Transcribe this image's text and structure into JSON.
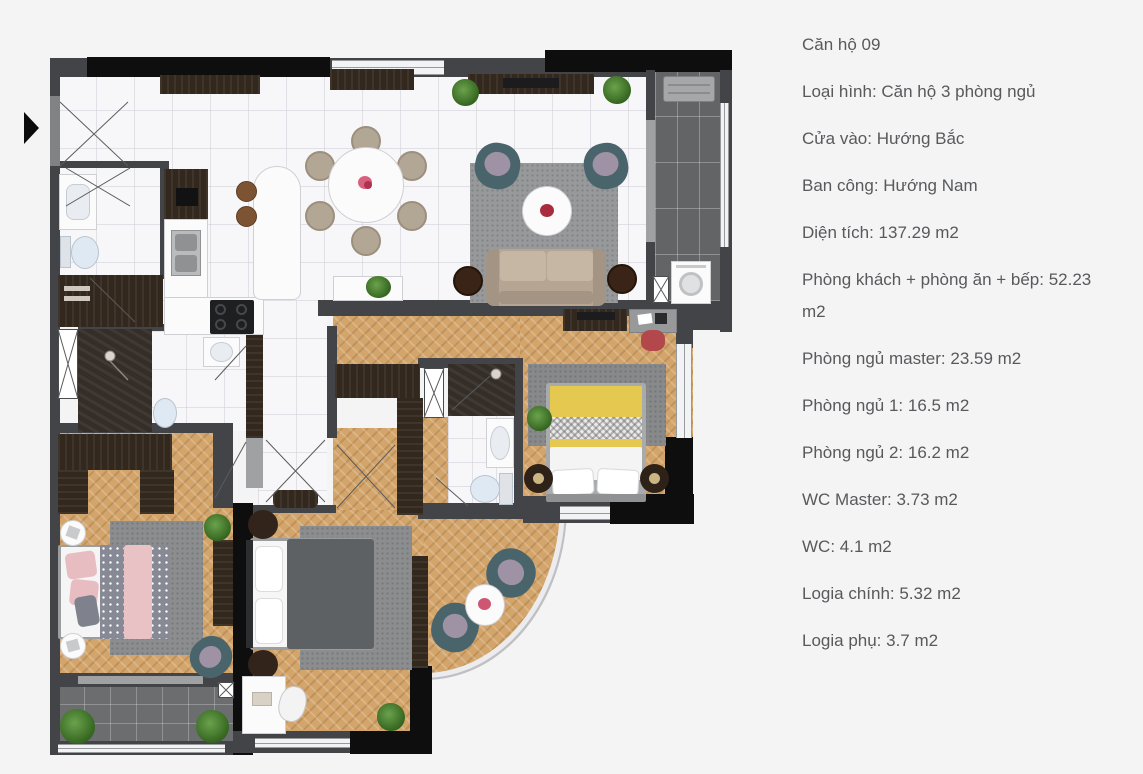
{
  "info_panel": {
    "title": "Căn hộ 09",
    "lines": [
      "Loại hình: Căn hộ 3 phòng ngủ",
      "Cửa vào: Hướng Bắc",
      "Ban công: Hướng Nam",
      "Diện tích: 137.29 m2",
      "Phòng khách + phòng ăn + bếp: 52.23 m2",
      "Phòng ngủ master: 23.59 m2",
      "Phòng ngủ 1: 16.5 m2",
      "Phòng ngủ 2: 16.2 m2",
      "WC Master: 3.73 m2",
      "WC: 4.1 m2",
      "Logia chính: 5.32 m2",
      "Logia phụ: 3.7 m2"
    ]
  },
  "floor_plan": {
    "type": "apartment-floor-plan-3-bedroom",
    "rooms": [
      "living-dining-kitchen",
      "bedroom-master",
      "bedroom-1",
      "bedroom-2",
      "wc-master",
      "wc",
      "logia-chinh",
      "logia-phu",
      "corridor",
      "entry"
    ],
    "palette": {
      "background": "#f4f4f5",
      "wall": "#434447",
      "wall_black": "#0e0e0f",
      "marble_floor": "#f7f7f9",
      "wood_floor": "#d3a56b",
      "balcony_tile": "#626466",
      "carpet": "#8f9193",
      "dark_wood_furniture": "#33281e",
      "sofa_beige": "#b6a593",
      "armchair_teal": "#4a646c",
      "bed_yellow": "#e5c84f",
      "blanket_pink": "#e9c2c6",
      "duvet_gray": "#5e6164",
      "desk_chair_red": "#b2484b",
      "flower_pink": "#d8607f",
      "flower_red": "#a92c3e"
    }
  }
}
